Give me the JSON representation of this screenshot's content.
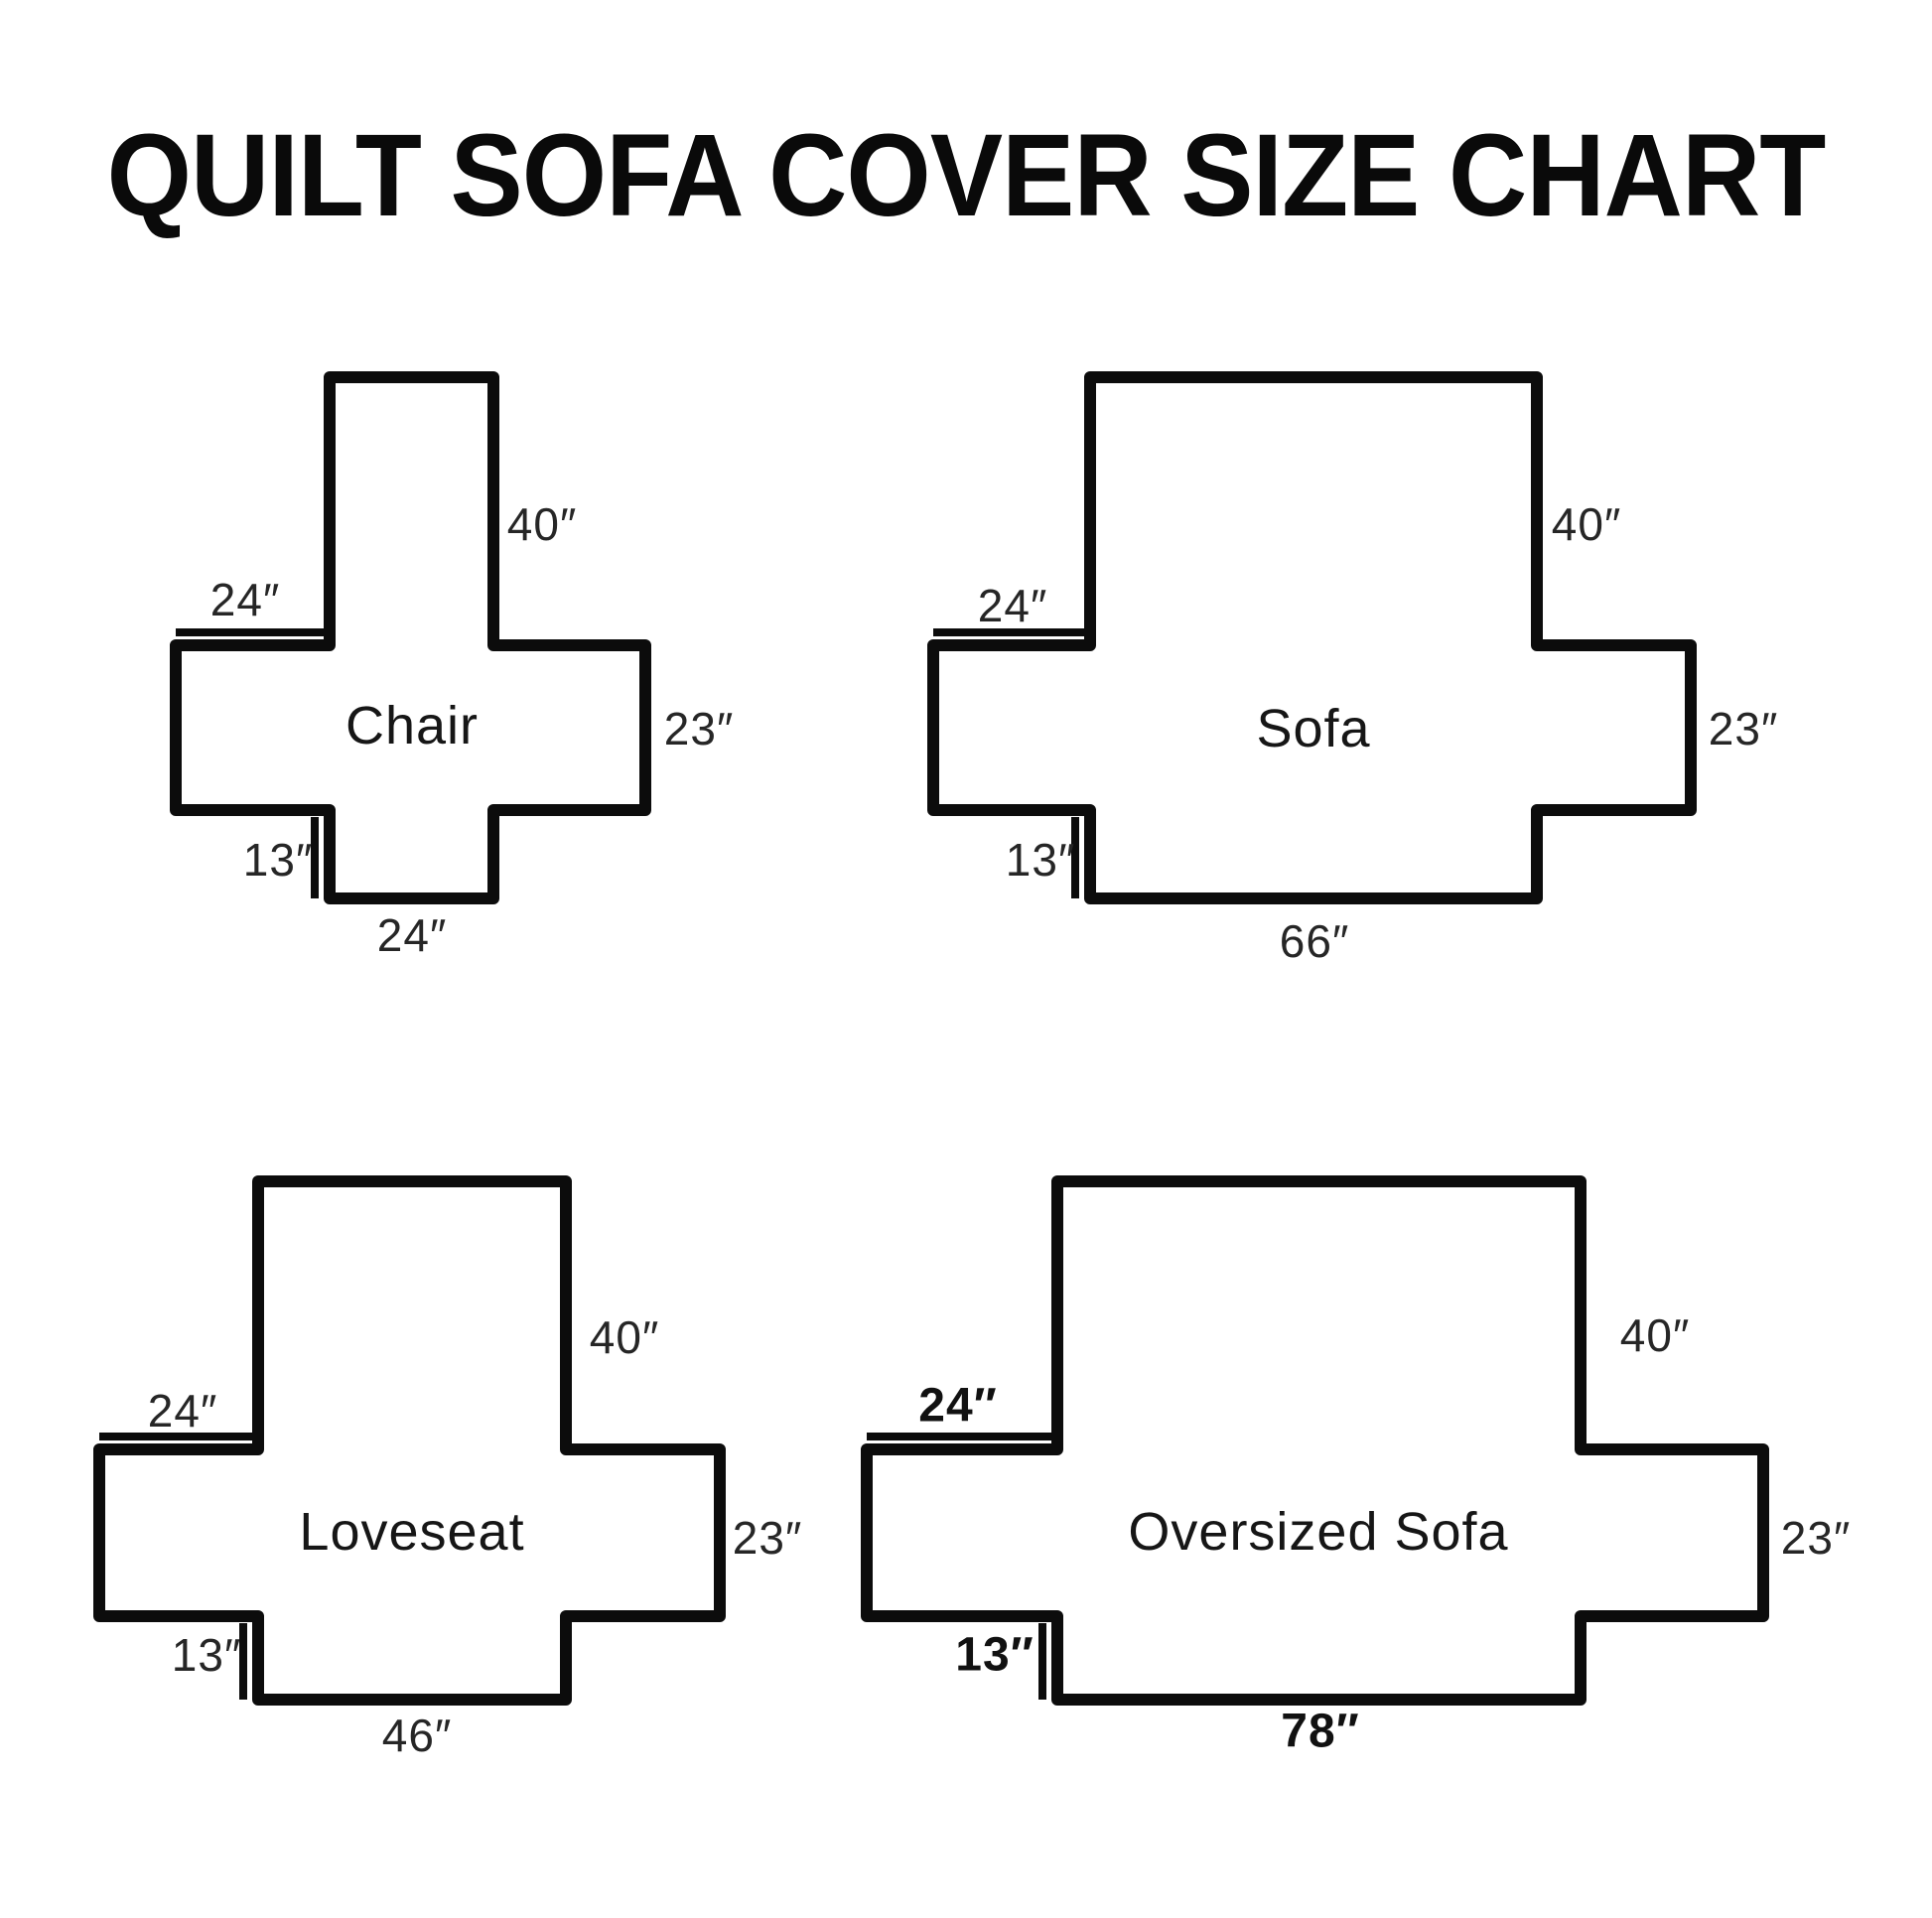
{
  "title": "QUILT SOFA COVER SIZE CHART",
  "colors": {
    "background": "#ffffff",
    "line": "#0c0c0c",
    "text": "#262626"
  },
  "diagrams": [
    {
      "id": "chair",
      "name": "Chair",
      "back_height": "40″",
      "top_arm_width": "24″",
      "side_height": "23″",
      "front_drop": "13″",
      "bottom_width": "24″"
    },
    {
      "id": "sofa",
      "name": "Sofa",
      "back_height": "40″",
      "top_arm_width": "24″",
      "side_height": "23″",
      "front_drop": "13″",
      "bottom_width": "66″"
    },
    {
      "id": "loveseat",
      "name": "Loveseat",
      "back_height": "40″",
      "top_arm_width": "24″",
      "side_height": "23″",
      "front_drop": "13″",
      "bottom_width": "46″"
    },
    {
      "id": "oversized-sofa",
      "name": "Oversized Sofa",
      "back_height": "40″",
      "top_arm_width": "24″",
      "side_height": "23″",
      "front_drop": "13″",
      "bottom_width": "78″"
    }
  ]
}
